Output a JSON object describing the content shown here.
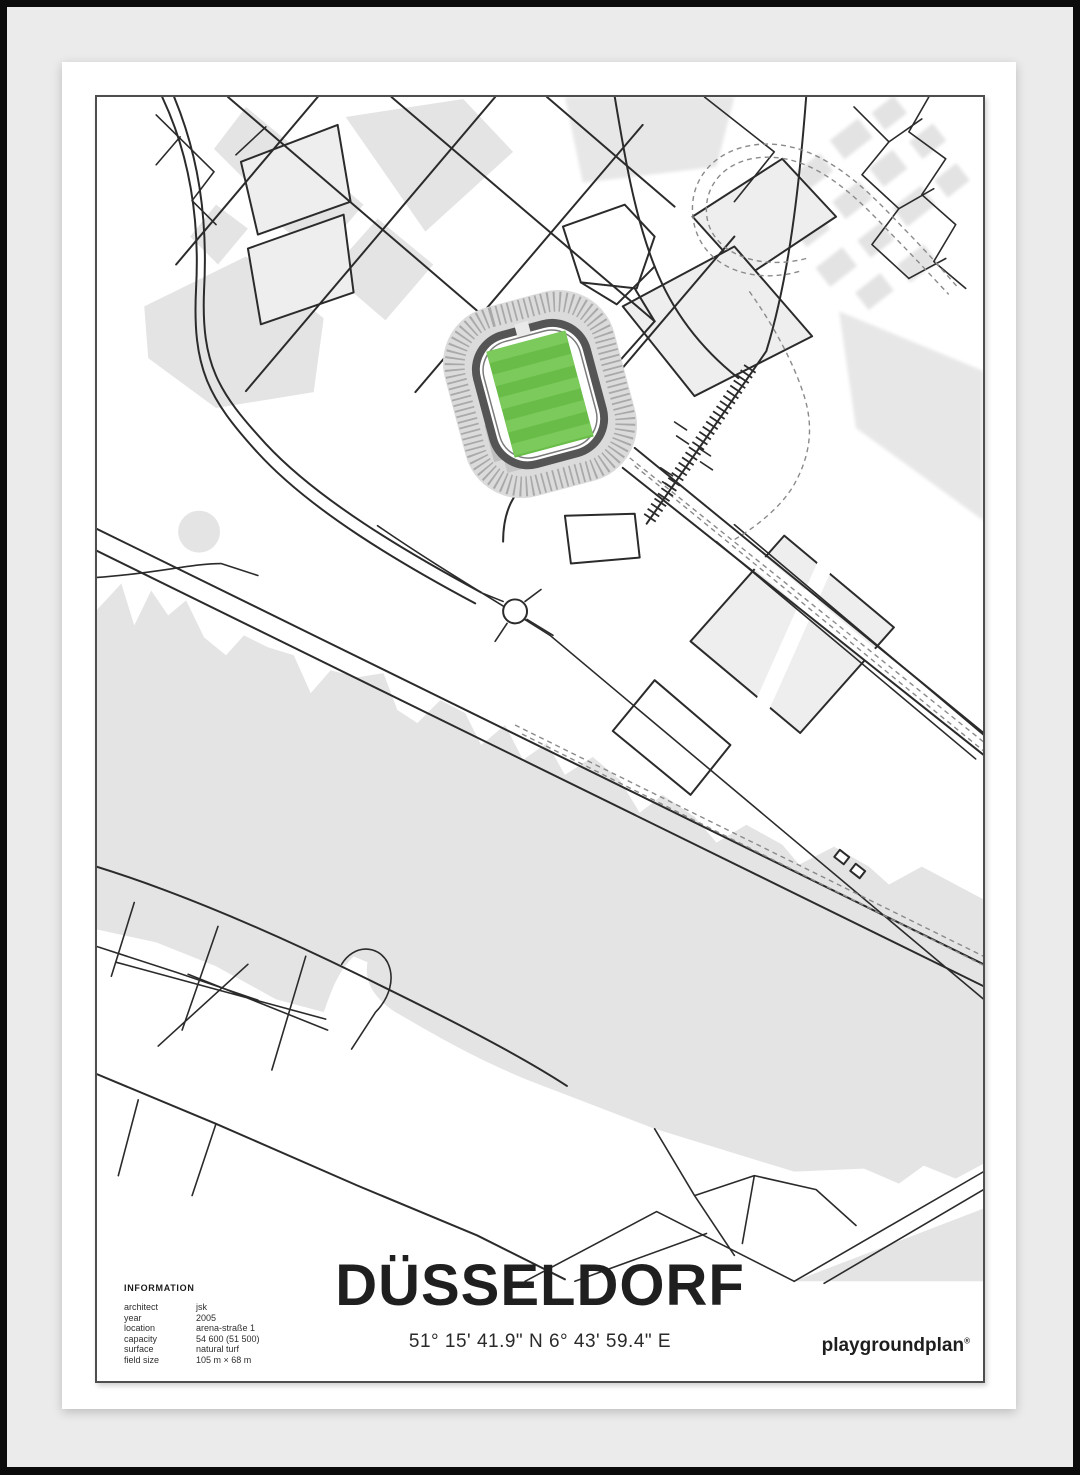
{
  "poster": {
    "title": "DÜSSELDORF",
    "coordinates": "51° 15' 41.9\" N  6° 43' 59.4\" E",
    "brand": "playgroundplan",
    "brand_mark": "®",
    "info": {
      "heading": "INFORMATION",
      "rows": [
        {
          "label": "architect",
          "value": "jsk"
        },
        {
          "label": "year",
          "value": "2005"
        },
        {
          "label": "location",
          "value": "arena-straße 1"
        },
        {
          "label": "capacity",
          "value": "54 600 (51 500)"
        },
        {
          "label": "surface",
          "value": "natural turf"
        },
        {
          "label": "field size",
          "value": "105 m × 68 m"
        }
      ]
    },
    "map": {
      "subject": "stadium street map with green pitch, river and tram lines",
      "colors": {
        "pitch_green": "#68bc47",
        "pitch_green_light": "#7bca5b",
        "stand_gray": "#dbdbdb",
        "roof_ring_gray": "#555555",
        "building_gray": "#e4e4e4",
        "river_gray": "#e3e3e3",
        "road_line": "#2b2b2b",
        "tram_line": "#8a8a8a",
        "frame_black": "#0b0b0b",
        "mat_gray": "#ebebeb",
        "paper_white": "#ffffff"
      }
    }
  }
}
